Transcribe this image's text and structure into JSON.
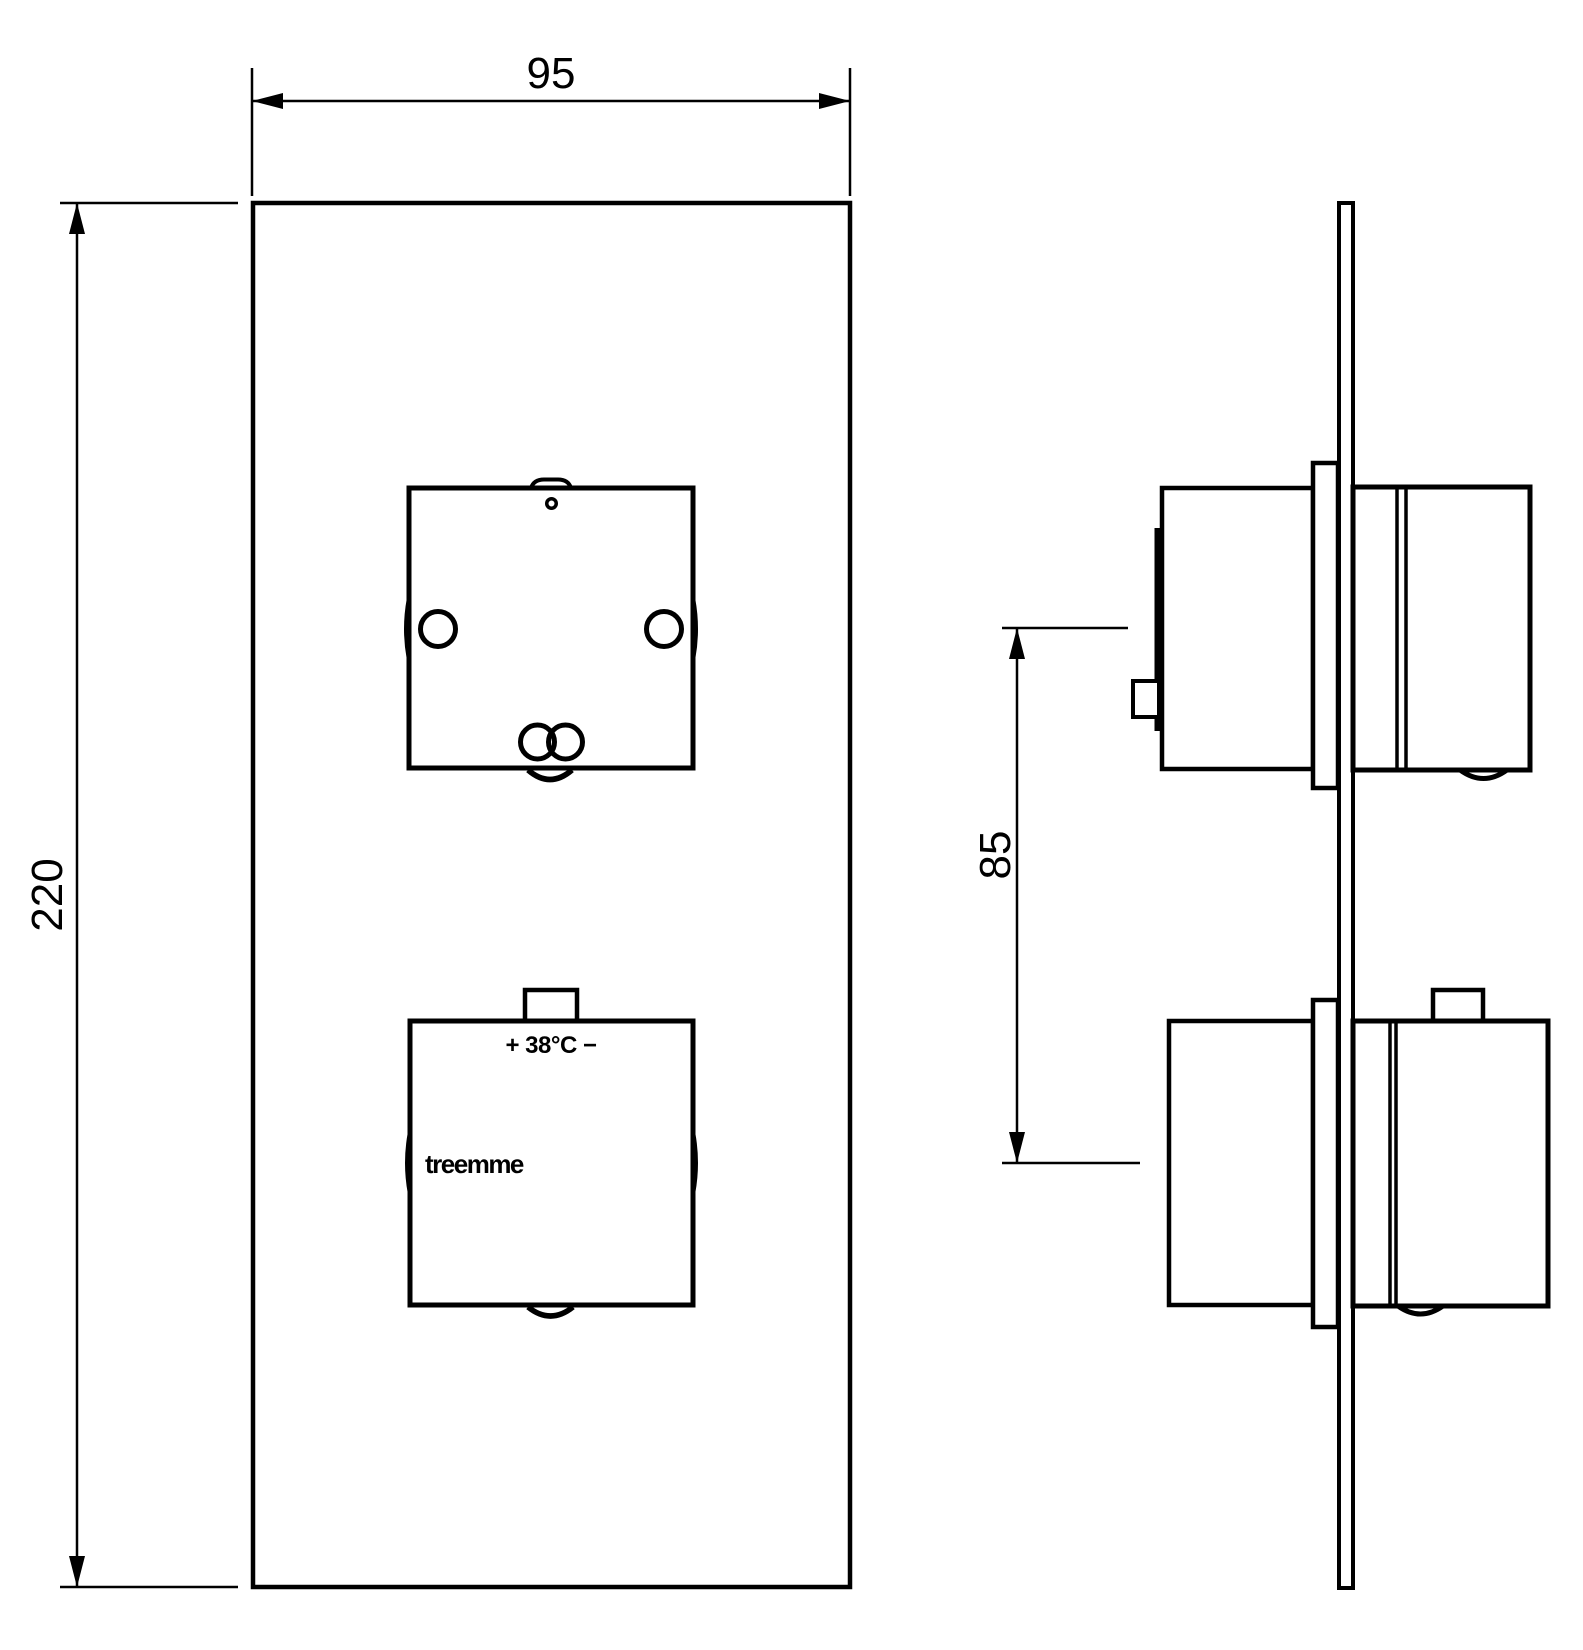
{
  "drawing": {
    "type": "technical-dimension-drawing",
    "product": "concealed thermostatic shower mixer trim plate, front and side views",
    "colors": {
      "line": "#000000",
      "background": "#ffffff"
    },
    "front_view": {
      "plate_width_dim": "95",
      "plate_height_dim": "220",
      "temperature_label": "+ 38°C −",
      "brand_label": "treemme"
    },
    "side_view": {
      "handle_spacing_dim": "85"
    }
  }
}
